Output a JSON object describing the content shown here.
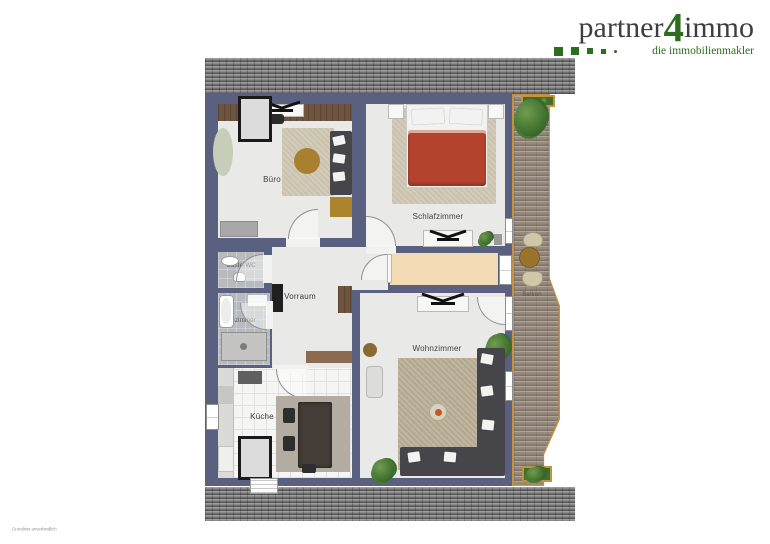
{
  "logo": {
    "brand_part1": "partner",
    "brand_number": "4",
    "brand_part2": "immo",
    "tagline": "die immobilienmakler"
  },
  "rooms": {
    "buero": {
      "label": "Büro"
    },
    "schlafzimmer": {
      "label": "Schlafzimmer"
    },
    "gaeste_wc": {
      "label": "Gäste-WC"
    },
    "badezimmer": {
      "label": "Badezimmer"
    },
    "vorraum": {
      "label": "Vorraum"
    },
    "kueche": {
      "label": "Küche"
    },
    "wohnzimmer": {
      "label": "Wohnzimmer"
    },
    "balkon": {
      "label": "Balkon"
    }
  },
  "fine_print": "Grundriss unverbindlich",
  "colors": {
    "wall": "#5a6180",
    "roof": "#8b8b8b",
    "floor": "#e9e9e7",
    "flur_floor": "#f2dab2",
    "deck": "#978a7d",
    "deck_border": "#c8913c",
    "bed_duvet": "#b4432e",
    "sofa": "#46464a",
    "rug": "#cbc2ad",
    "wood": "#6f5540",
    "logo_green": "#2d6e1e",
    "logo_text": "#3f3e3e"
  },
  "icons": {
    "ceiling_fan_icon": "rotor-blades-top-view (css/svg shape)",
    "plant_icon": "green-foliage (css radial shape)"
  }
}
